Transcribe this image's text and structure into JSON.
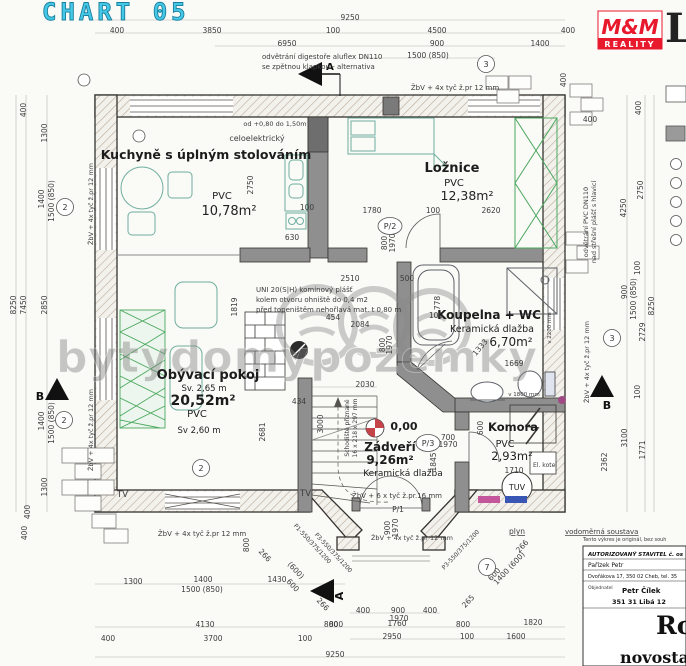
{
  "header": {
    "title": "CHART 05",
    "logo_top": "M&M",
    "logo_bottom": "REALITY",
    "corner_letter": "L"
  },
  "watermark": {
    "text": "bytydomypozemky"
  },
  "rooms": {
    "kitchen": {
      "name": "Kuchyně s úplným stolováním",
      "floor": "PVC",
      "area": "10,78m²"
    },
    "bedroom": {
      "name": "Ložnice",
      "floor": "PVC",
      "area": "12,38m²"
    },
    "bathroom": {
      "name": "Koupelna + WC",
      "floor": "Keramická dlažba",
      "area": "6,70m²"
    },
    "living": {
      "name": "Obývací pokoj",
      "height_a": "Sv. 2,65 m",
      "area": "20,52m²",
      "floor": "PVC",
      "height_b": "Sv 2,60 m"
    },
    "hall": {
      "name": "Zádveří",
      "area": "9,26m²",
      "floor": "Keramická dlažba",
      "elevation": "0,00"
    },
    "storage": {
      "name": "Komora",
      "floor": "PVC",
      "area": "2,93m²",
      "tank": "TUV"
    }
  },
  "section_marks": {
    "a": "A",
    "b": "B"
  },
  "annotations": [
    {
      "x": 262,
      "y": 59,
      "t": "odvětrání digestoře aluflex DN110",
      "a": "start",
      "s": 7
    },
    {
      "x": 262,
      "y": 69,
      "t": "se zpětnou klapkou - alternativa",
      "a": "start",
      "s": 7
    },
    {
      "x": 455,
      "y": 90,
      "t": "ŽbV + 4x tyč ž.pr 12 mm",
      "s": 7
    },
    {
      "x": 93,
      "y": 204,
      "t": "ŽbV + 4x tyč ž.pr 12 mm",
      "r": -90,
      "s": 6.5
    },
    {
      "x": 93,
      "y": 430,
      "t": "ŽbV + 4x tyč ž.pr 12 mm",
      "r": -90,
      "s": 6.5
    },
    {
      "x": 589,
      "y": 362,
      "t": "ŽbV + 4x tyč ž.pr 12 mm",
      "r": -90,
      "s": 6.5
    },
    {
      "x": 202,
      "y": 536,
      "t": "ŽbV + 4x tyč ž.pr 12 mm",
      "s": 7
    },
    {
      "x": 397,
      "y": 498,
      "t": "ŽbV + 6 x tyč ž.pr.16 mm",
      "s": 7
    },
    {
      "x": 412,
      "y": 540,
      "t": "ŽbV + 4x tyč ž.pr 12 mm",
      "s": 6.5
    },
    {
      "x": 256,
      "y": 292,
      "t": "UNI 20(S|H) komínový plášť",
      "a": "start",
      "s": 7
    },
    {
      "x": 256,
      "y": 302,
      "t": "kolem otvoru ohniště do 0,4 m2",
      "a": "start",
      "s": 7
    },
    {
      "x": 256,
      "y": 312,
      "t": "před topeništěm nehořlavá mat. t 0,80 m",
      "a": "start",
      "s": 7
    },
    {
      "x": 275,
      "y": 126,
      "t": "od +0,80 do 1,50m",
      "s": 6.5
    },
    {
      "x": 257,
      "y": 141,
      "t": "celoelektrický",
      "s": 8
    },
    {
      "x": 349,
      "y": 428,
      "t": "Schodiště přiznané",
      "r": -90,
      "s": 6
    },
    {
      "x": 357,
      "y": 428,
      "t": "16 x 218 x 297 mm",
      "r": -90,
      "s": 6
    },
    {
      "x": 588,
      "y": 222,
      "t": "odvětrání PVC DN110",
      "r": -90,
      "s": 6.5
    },
    {
      "x": 596,
      "y": 222,
      "t": "nad střešní plášť s hlavicí",
      "r": -90,
      "s": 6.5
    },
    {
      "x": 517,
      "y": 534,
      "t": "plyn",
      "s": 7.5,
      "u": true
    },
    {
      "x": 565,
      "y": 534,
      "t": "vodoměrná soustava",
      "a": "start",
      "s": 7,
      "u": true
    },
    {
      "x": 583,
      "y": 541,
      "t": "Tento výkres je originál, bez souh",
      "a": "start",
      "s": 5
    },
    {
      "x": 117,
      "y": 497,
      "t": "TV",
      "s": 8.5,
      "a": "start"
    },
    {
      "x": 300,
      "y": 496,
      "t": "TV",
      "s": 8.5,
      "a": "start"
    },
    {
      "x": 551,
      "y": 328,
      "t": "v 2200 mm",
      "r": -90,
      "s": 5.5
    },
    {
      "x": 524,
      "y": 396,
      "t": "v 1800 mm",
      "s": 5.5
    },
    {
      "x": 311,
      "y": 545,
      "t": "P1-550/375/1200",
      "r": 47,
      "s": 6
    },
    {
      "x": 332,
      "y": 554,
      "t": "P3-550/375/1200",
      "r": 47,
      "s": 6
    },
    {
      "x": 462,
      "y": 551,
      "t": "P3-550/375/1200",
      "r": -47,
      "s": 6
    },
    {
      "x": 545,
      "y": 467,
      "t": "El. kotel",
      "s": 6
    }
  ],
  "dimensions": [
    {
      "x": 350,
      "y": 20,
      "t": "9250"
    },
    {
      "x": 117,
      "y": 33,
      "t": "400"
    },
    {
      "x": 212,
      "y": 33,
      "t": "3850"
    },
    {
      "x": 333,
      "y": 33,
      "t": "100"
    },
    {
      "x": 437,
      "y": 33,
      "t": "4500"
    },
    {
      "x": 568,
      "y": 33,
      "t": "400"
    },
    {
      "x": 287,
      "y": 46,
      "t": "6950"
    },
    {
      "x": 437,
      "y": 46,
      "t": "900"
    },
    {
      "x": 540,
      "y": 46,
      "t": "1400"
    },
    {
      "x": 428,
      "y": 58,
      "t": "1500  (850)"
    },
    {
      "x": 566,
      "y": 80,
      "t": "400",
      "r": -90
    },
    {
      "x": 16,
      "y": 305,
      "t": "8250",
      "r": -90
    },
    {
      "x": 26,
      "y": 305,
      "t": "7450",
      "r": -90
    },
    {
      "x": 26,
      "y": 110,
      "t": "400",
      "r": -90
    },
    {
      "x": 47,
      "y": 133,
      "t": "1300",
      "r": -90
    },
    {
      "x": 44,
      "y": 199,
      "t": "1400",
      "r": -90
    },
    {
      "x": 54,
      "y": 201,
      "t": "1500 (850)",
      "r": -90
    },
    {
      "x": 47,
      "y": 305,
      "t": "2850",
      "r": -90
    },
    {
      "x": 44,
      "y": 421,
      "t": "1400",
      "r": -90
    },
    {
      "x": 54,
      "y": 423,
      "t": "1500 (850)",
      "r": -90
    },
    {
      "x": 47,
      "y": 487,
      "t": "1300",
      "r": -90
    },
    {
      "x": 30,
      "y": 512,
      "t": "400",
      "r": -90
    },
    {
      "x": 27,
      "y": 533,
      "t": "400",
      "r": -90
    },
    {
      "x": 590,
      "y": 122,
      "t": "400"
    },
    {
      "x": 641,
      "y": 108,
      "t": "400",
      "r": -90
    },
    {
      "x": 643,
      "y": 190,
      "t": "2750",
      "r": -90
    },
    {
      "x": 626,
      "y": 208,
      "t": "4250",
      "r": -90
    },
    {
      "x": 627,
      "y": 292,
      "t": "900",
      "r": -90
    },
    {
      "x": 636,
      "y": 299,
      "t": "1500 (850)",
      "r": -90
    },
    {
      "x": 640,
      "y": 268,
      "t": "100",
      "r": -90
    },
    {
      "x": 645,
      "y": 332,
      "t": "2729",
      "r": -90
    },
    {
      "x": 654,
      "y": 306,
      "t": "8250",
      "r": -90
    },
    {
      "x": 640,
      "y": 392,
      "t": "100",
      "r": -90
    },
    {
      "x": 627,
      "y": 438,
      "t": "3100",
      "r": -90
    },
    {
      "x": 645,
      "y": 450,
      "t": "1771",
      "r": -90
    },
    {
      "x": 607,
      "y": 462,
      "t": "2362",
      "r": -90
    },
    {
      "x": 249,
      "y": 545,
      "t": "800",
      "r": -90
    },
    {
      "x": 133,
      "y": 584,
      "t": "1300"
    },
    {
      "x": 203,
      "y": 582,
      "t": "1400"
    },
    {
      "x": 202,
      "y": 592,
      "t": "1500  (850)"
    },
    {
      "x": 277,
      "y": 582,
      "t": "1430"
    },
    {
      "x": 205,
      "y": 627,
      "t": "4130"
    },
    {
      "x": 108,
      "y": 641,
      "t": "400"
    },
    {
      "x": 213,
      "y": 641,
      "t": "3700"
    },
    {
      "x": 305,
      "y": 641,
      "t": "100"
    },
    {
      "x": 331,
      "y": 627,
      "t": "800"
    },
    {
      "x": 335,
      "y": 657,
      "t": "9250"
    },
    {
      "x": 398,
      "y": 512,
      "t": "P/1"
    },
    {
      "x": 390,
      "y": 528,
      "t": "900",
      "r": -90
    },
    {
      "x": 398,
      "y": 528,
      "t": "1970",
      "r": -90
    },
    {
      "x": 496,
      "y": 576,
      "t": "600",
      "r": -47
    },
    {
      "x": 511,
      "y": 570,
      "t": "1400 (600)",
      "r": -47
    },
    {
      "x": 524,
      "y": 548,
      "t": "266",
      "r": -47
    },
    {
      "x": 470,
      "y": 603,
      "t": "265",
      "r": -47
    },
    {
      "x": 263,
      "y": 557,
      "t": "266",
      "r": 47
    },
    {
      "x": 294,
      "y": 572,
      "t": "(600)",
      "r": 47
    },
    {
      "x": 291,
      "y": 587,
      "t": "600",
      "r": 47
    },
    {
      "x": 321,
      "y": 606,
      "t": "266",
      "r": 47
    },
    {
      "x": 363,
      "y": 613,
      "t": "400"
    },
    {
      "x": 398,
      "y": 613,
      "t": "900"
    },
    {
      "x": 430,
      "y": 613,
      "t": "400"
    },
    {
      "x": 399,
      "y": 621,
      "t": "1970"
    },
    {
      "x": 397,
      "y": 626,
      "t": "1760"
    },
    {
      "x": 336,
      "y": 627,
      "t": "800"
    },
    {
      "x": 463,
      "y": 627,
      "t": "800"
    },
    {
      "x": 533,
      "y": 625,
      "t": "1820"
    },
    {
      "x": 392,
      "y": 639,
      "t": "2950"
    },
    {
      "x": 467,
      "y": 639,
      "t": "100"
    },
    {
      "x": 516,
      "y": 639,
      "t": "1600"
    },
    {
      "x": 253,
      "y": 185,
      "t": "2750",
      "r": -90
    },
    {
      "x": 307,
      "y": 210,
      "t": "100"
    },
    {
      "x": 292,
      "y": 240,
      "t": "630"
    },
    {
      "x": 372,
      "y": 213,
      "t": "1780"
    },
    {
      "x": 433,
      "y": 213,
      "t": "100"
    },
    {
      "x": 491,
      "y": 213,
      "t": "2620"
    },
    {
      "x": 387,
      "y": 243,
      "t": "800",
      "r": -90
    },
    {
      "x": 395,
      "y": 243,
      "t": "1970",
      "r": -90
    },
    {
      "x": 350,
      "y": 281,
      "t": "2510"
    },
    {
      "x": 407,
      "y": 281,
      "t": "500"
    },
    {
      "x": 237,
      "y": 307,
      "t": "1819",
      "r": -90
    },
    {
      "x": 299,
      "y": 404,
      "t": "434"
    },
    {
      "x": 265,
      "y": 432,
      "t": "2681",
      "r": -90
    },
    {
      "x": 333,
      "y": 320,
      "t": "454"
    },
    {
      "x": 360,
      "y": 327,
      "t": "2084"
    },
    {
      "x": 385,
      "y": 345,
      "t": "800",
      "r": -90
    },
    {
      "x": 392,
      "y": 345,
      "t": "1970",
      "r": -90
    },
    {
      "x": 436,
      "y": 318,
      "t": "100"
    },
    {
      "x": 440,
      "y": 303,
      "t": "778",
      "r": -90
    },
    {
      "x": 514,
      "y": 366,
      "t": "1669"
    },
    {
      "x": 482,
      "y": 349,
      "t": "1333",
      "r": -50
    },
    {
      "x": 365,
      "y": 387,
      "t": "2030"
    },
    {
      "x": 323,
      "y": 424,
      "t": "3000",
      "r": -90
    },
    {
      "x": 436,
      "y": 462,
      "t": "1845",
      "r": -90
    },
    {
      "x": 448,
      "y": 440,
      "t": "700"
    },
    {
      "x": 448,
      "y": 447,
      "t": "1970"
    },
    {
      "x": 483,
      "y": 428,
      "t": "600",
      "r": -90
    },
    {
      "x": 514,
      "y": 473,
      "t": "1710"
    }
  ],
  "markers": [
    {
      "x": 486,
      "y": 64,
      "t": "3"
    },
    {
      "x": 65,
      "y": 207,
      "t": "2"
    },
    {
      "x": 64,
      "y": 420,
      "t": "2"
    },
    {
      "x": 201,
      "y": 468,
      "t": "2"
    },
    {
      "x": 612,
      "y": 338,
      "t": "3"
    },
    {
      "x": 487,
      "y": 567,
      "t": "7"
    },
    {
      "x": 390,
      "y": 226,
      "t": "P/2"
    },
    {
      "x": 428,
      "y": 443,
      "t": "P/3"
    },
    {
      "x": 84,
      "y": 80,
      "t": ""
    },
    {
      "x": 139,
      "y": 136,
      "t": ""
    }
  ],
  "title_block": {
    "header": "AUTORIZOVANÝ STAVITEL č. os",
    "name": "Pařízek Petr",
    "address": "Dvořákova 17, 350 02 Cheb, tel. 35",
    "client_label": "Objednatel",
    "client": "Petr Čílek",
    "client_addr": "351 31 Libá 12",
    "big_text": "Ro",
    "bottom_text": "novostavb"
  },
  "colors": {
    "title_cyan": "#45c8e6",
    "logo_red": "#e8192c",
    "furniture_teal": "#6fae9f",
    "furniture_green": "#4aa85e",
    "elevation_red": "#c4444a",
    "accent_magenta": "#c4569b",
    "accent_blue": "#3a56b4"
  }
}
